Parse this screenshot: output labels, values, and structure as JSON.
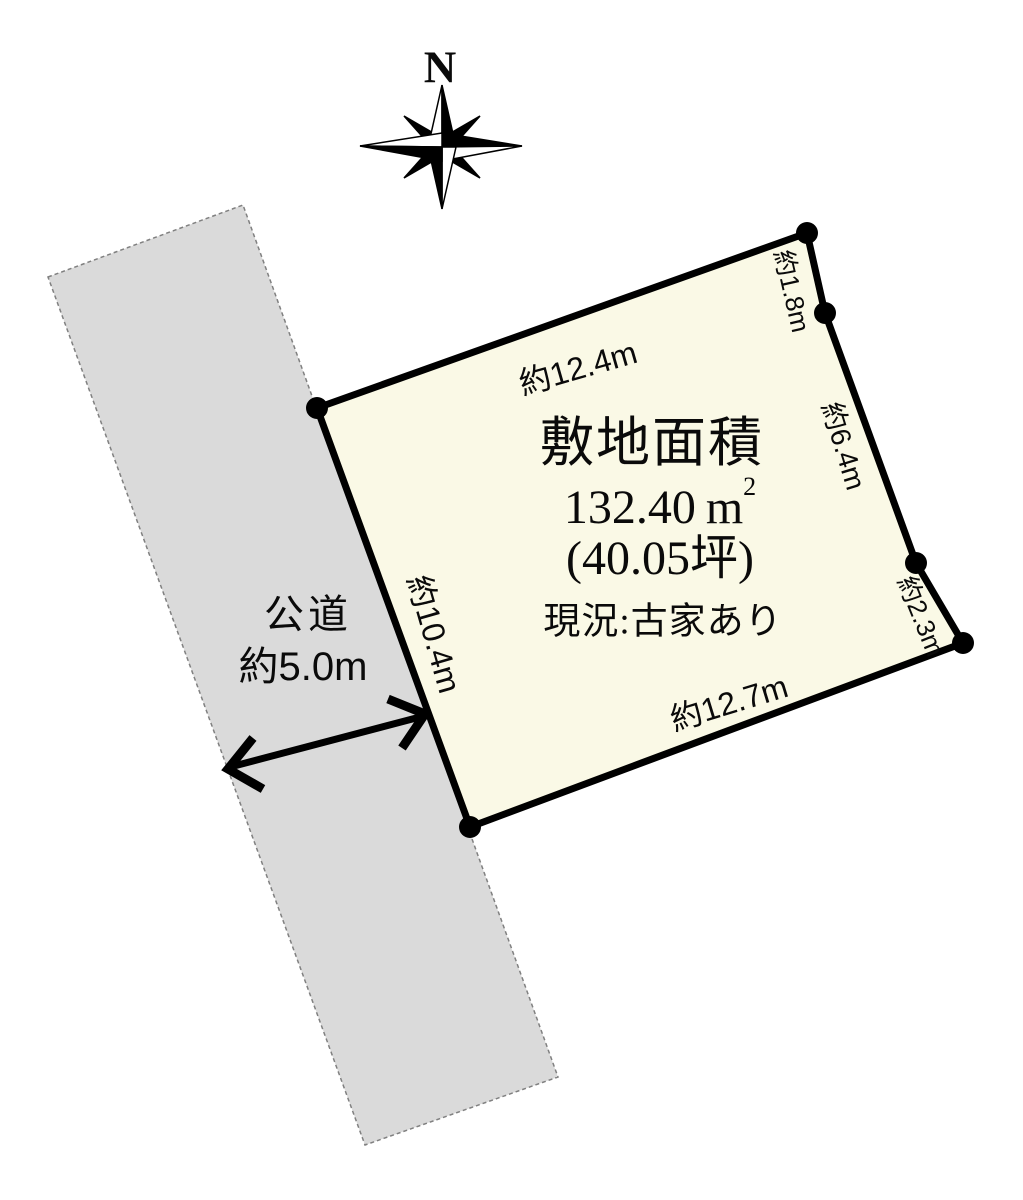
{
  "compass": {
    "north_label": "N"
  },
  "road": {
    "name": "公道",
    "width": "約5.0m"
  },
  "parcel": {
    "title": "敷地面積",
    "area_value": "132.40",
    "area_unit": "m",
    "area_exponent": "2",
    "area_tsubo": "(40.05坪)",
    "status": "現況:古家あり",
    "edges": {
      "top": "約12.4m",
      "upper_right": "約1.8m",
      "right": "約6.4m",
      "lower_right": "約2.3m",
      "bottom": "約12.7m",
      "left": "約10.4m"
    }
  },
  "colors": {
    "parcel_fill": "#FAF9E6",
    "road_fill": "#DADADA",
    "outline": "#000000"
  }
}
